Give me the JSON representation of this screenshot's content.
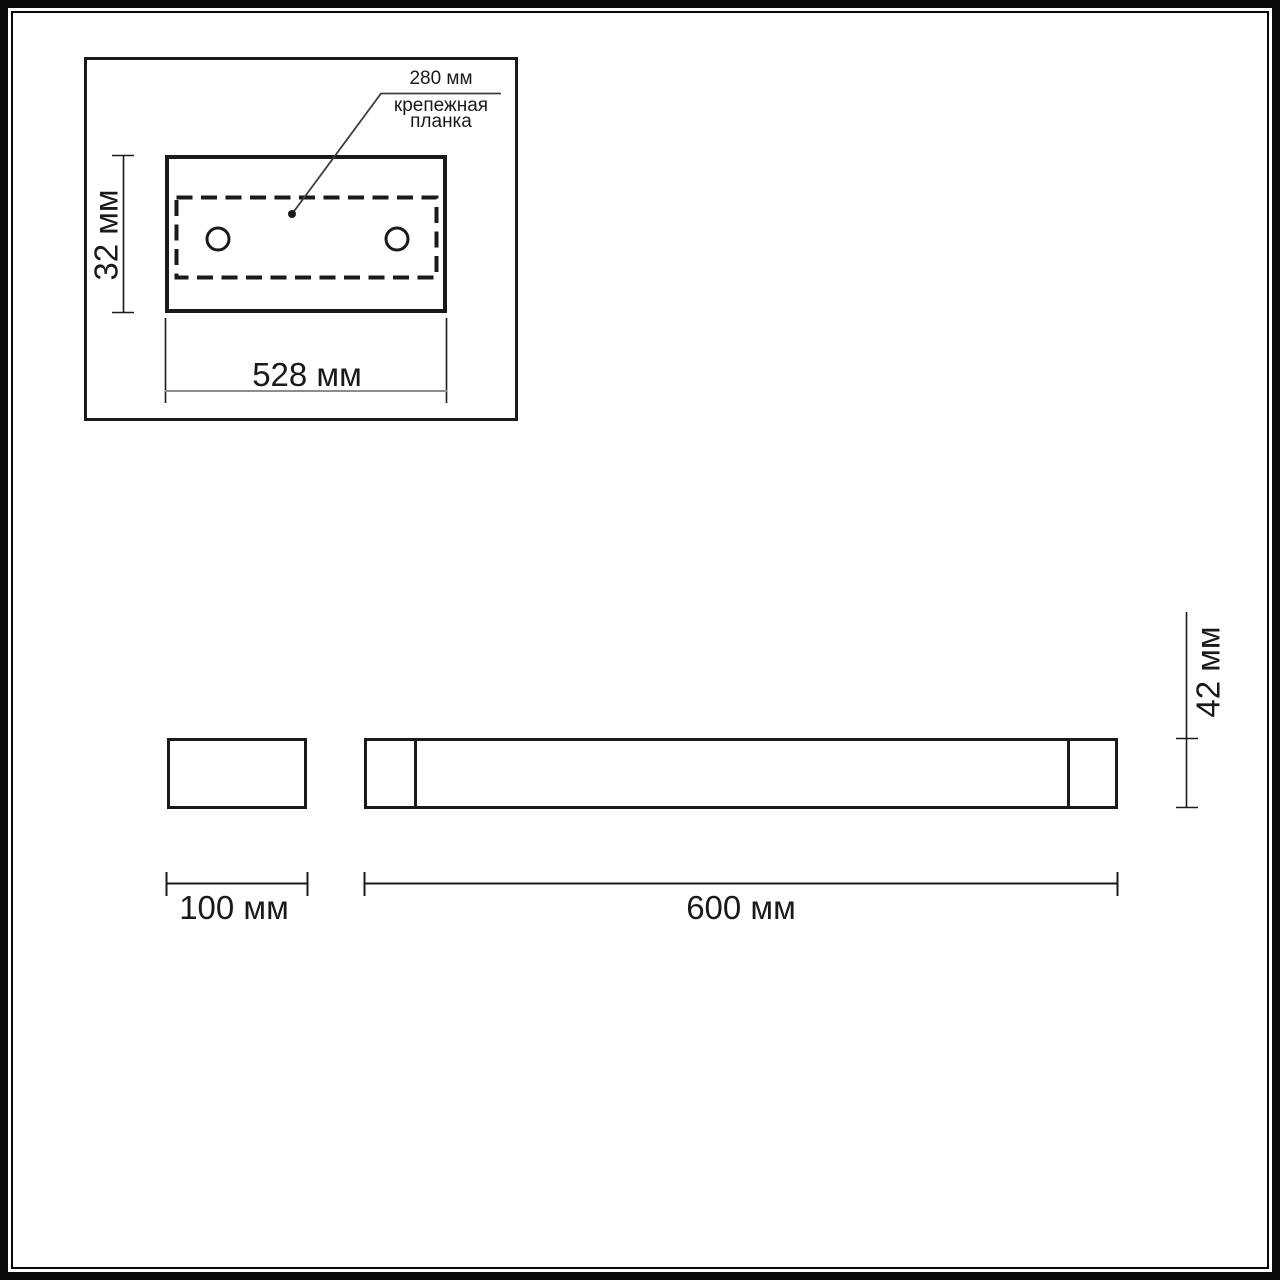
{
  "drawing": {
    "title": "wall-light dimension drawing",
    "detail_view": {
      "hole_spacing_label": "280 мм",
      "bracket_label": "крепежная\nпланка",
      "height_label": "32 мм",
      "width_label": "528 мм"
    },
    "side_view": {
      "backplate_width_label": "100 мм",
      "body_width_label": "600 мм",
      "height_label": "42 мм"
    }
  },
  "colors": {
    "line": "#1a1a1a",
    "dim_line": "#8c8c8c",
    "leader_line": "#3d3d3d",
    "background": "#ffffff"
  }
}
